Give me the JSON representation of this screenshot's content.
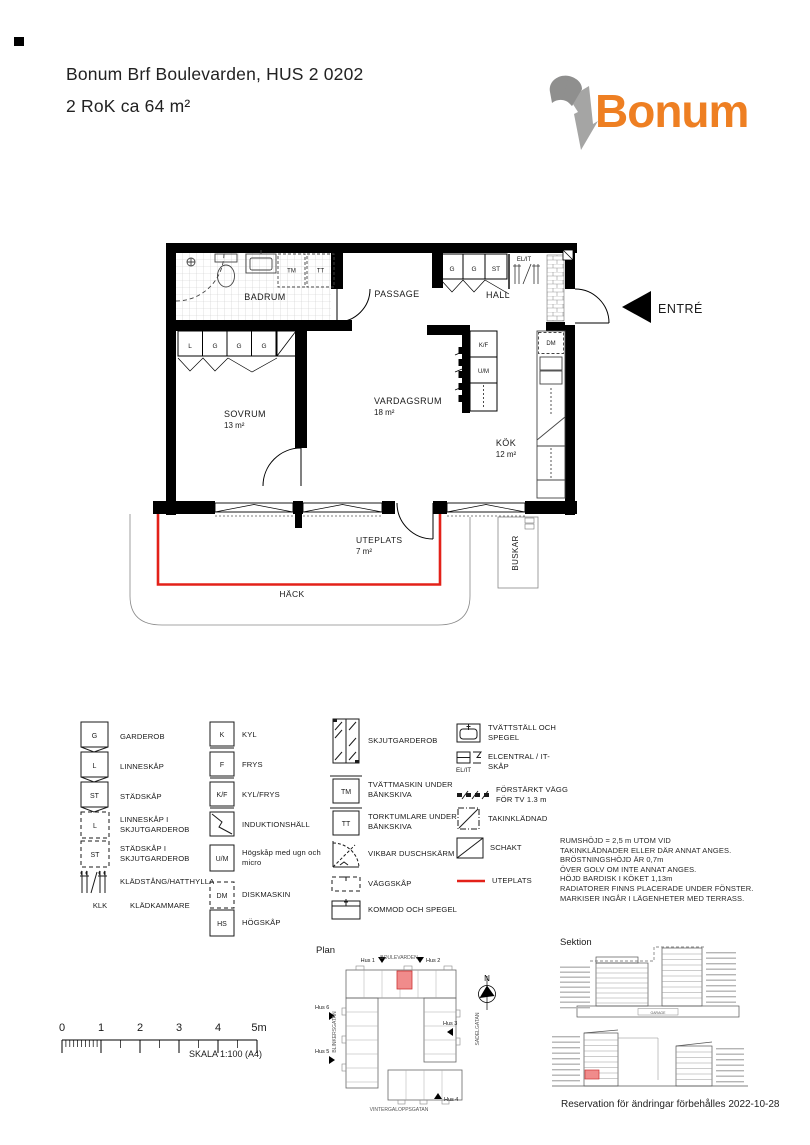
{
  "page": {
    "title_line1": "Bonum Brf Boulevarden, HUS 2  0202",
    "title_line2": "2 RoK ca  64 m²"
  },
  "logo": {
    "text": "Bonum",
    "orange": "#EE7F22",
    "gray_dark": "#8F8F8E",
    "gray_light": "#A5A5A4"
  },
  "floorplan": {
    "rooms": {
      "badrum": {
        "name": "BADRUM"
      },
      "passage": {
        "name": "PASSAGE"
      },
      "hall": {
        "name": "HALL"
      },
      "sovrum": {
        "name": "SOVRUM",
        "area": "13 m²"
      },
      "vardagsrum": {
        "name": "VARDAGSRUM",
        "area": "18 m²"
      },
      "kok": {
        "name": "KÖK",
        "area": "12 m²"
      },
      "uteplats": {
        "name": "UTEPLATS",
        "area": "7 m²"
      }
    },
    "labels": {
      "hack": "HÄCK",
      "buskar": "BUSKAR",
      "entre": "ENTRÉ",
      "el_it": "EL/IT",
      "tm": "TM",
      "tt": "TT",
      "dm": "DM",
      "kf": "K/F",
      "um": "U/M"
    },
    "hall_cabinets": [
      "G",
      "G",
      "ST"
    ],
    "sovrum_cabinets": [
      "L",
      "G",
      "G",
      "G"
    ],
    "colors": {
      "uteplats_line": "#E32119",
      "highlight_fill": "#F08B8B"
    }
  },
  "legend": {
    "col1": [
      {
        "code": "G",
        "label": "GARDEROB"
      },
      {
        "code": "L",
        "label": "LINNESKÅP"
      },
      {
        "code": "ST",
        "label": "STÄDSKÅP"
      },
      {
        "code": "L",
        "label": "LINNESKÅP I SKJUTGARDEROB"
      },
      {
        "code": "ST",
        "label": "STÄDSKÅP I SKJUTGARDEROB"
      },
      {
        "code": "",
        "label": "KLÄDSTÅNG/HATTHYLLA"
      },
      {
        "code": "KLK",
        "label": "KLÄDKAMMARE"
      }
    ],
    "col2": [
      {
        "code": "K",
        "label": "KYL"
      },
      {
        "code": "F",
        "label": "FRYS"
      },
      {
        "code": "K/F",
        "label": "KYL/FRYS"
      },
      {
        "code": "",
        "label": "INDUKTIONSHÄLL"
      },
      {
        "code": "U/M",
        "label": "Högskåp med ugn och micro"
      },
      {
        "code": "DM",
        "label": "DISKMASKIN"
      },
      {
        "code": "HS",
        "label": "HÖGSKÅP"
      }
    ],
    "col3": [
      {
        "code": "",
        "label": "SKJUTGARDEROB"
      },
      {
        "code": "TM",
        "label": "TVÄTTMASKIN UNDER BÄNKSKIVA"
      },
      {
        "code": "TT",
        "label": "TORKTUMLARE UNDER BÄNKSKIVA"
      },
      {
        "code": "",
        "label": "VIKBAR DUSCHSKÄRM"
      },
      {
        "code": "",
        "label": "VÄGGSKÅP"
      },
      {
        "code": "",
        "label": "KOMMOD OCH SPEGEL"
      }
    ],
    "col4": [
      {
        "code": "",
        "label": "TVÄTTSTÄLL OCH SPEGEL"
      },
      {
        "code": "",
        "label": "ELCENTRAL / IT-SKÅP",
        "sub": "EL/IT"
      },
      {
        "code": "",
        "label": "FÖRSTÄRKT VÄGG FÖR TV 1.3 m"
      },
      {
        "code": "",
        "label": "TAKINKLÄDNAD"
      },
      {
        "code": "",
        "label": "SCHAKT"
      },
      {
        "code": "",
        "label": "UTEPLATS"
      }
    ]
  },
  "notes": {
    "lines": [
      "RUMSHÖJD = 2,5 m UTOM VID",
      "TAKINKLÄDNADER ELLER DÄR ANNAT ANGES.",
      "BRÖSTNINGSHÖJD ÄR  0,7m",
      " ÖVER GOLV OM INTE ANNAT ANGES.",
      "HÖJD BARDISK I KÖKET 1,13m",
      "RADIATORER FINNS PLACERADE UNDER FÖNSTER.",
      "MARKISER INGÅR I LÄGENHETER MED TERRASS."
    ]
  },
  "scalebar": {
    "ticks": [
      "0",
      "1",
      "2",
      "3",
      "4",
      "5m"
    ],
    "label": "SKALA 1:100 (A4)"
  },
  "siteplan": {
    "title": "Plan",
    "streets": {
      "top": "BOULEVARDEN",
      "left": "BLINKERSGATAN",
      "right": "SADELGATAN",
      "bottom": "VINTERGALOPPSGATAN"
    },
    "houses": [
      "Hus 1",
      "Hus 2",
      "Hus 3",
      "Hus 4",
      "Hus 5",
      "Hus 6"
    ],
    "compass": "N"
  },
  "sektion": {
    "title": "Sektion",
    "garage": "GARAGE"
  },
  "footer": {
    "reservation": "Reservation för ändringar förbehålles 2022-10-28"
  }
}
